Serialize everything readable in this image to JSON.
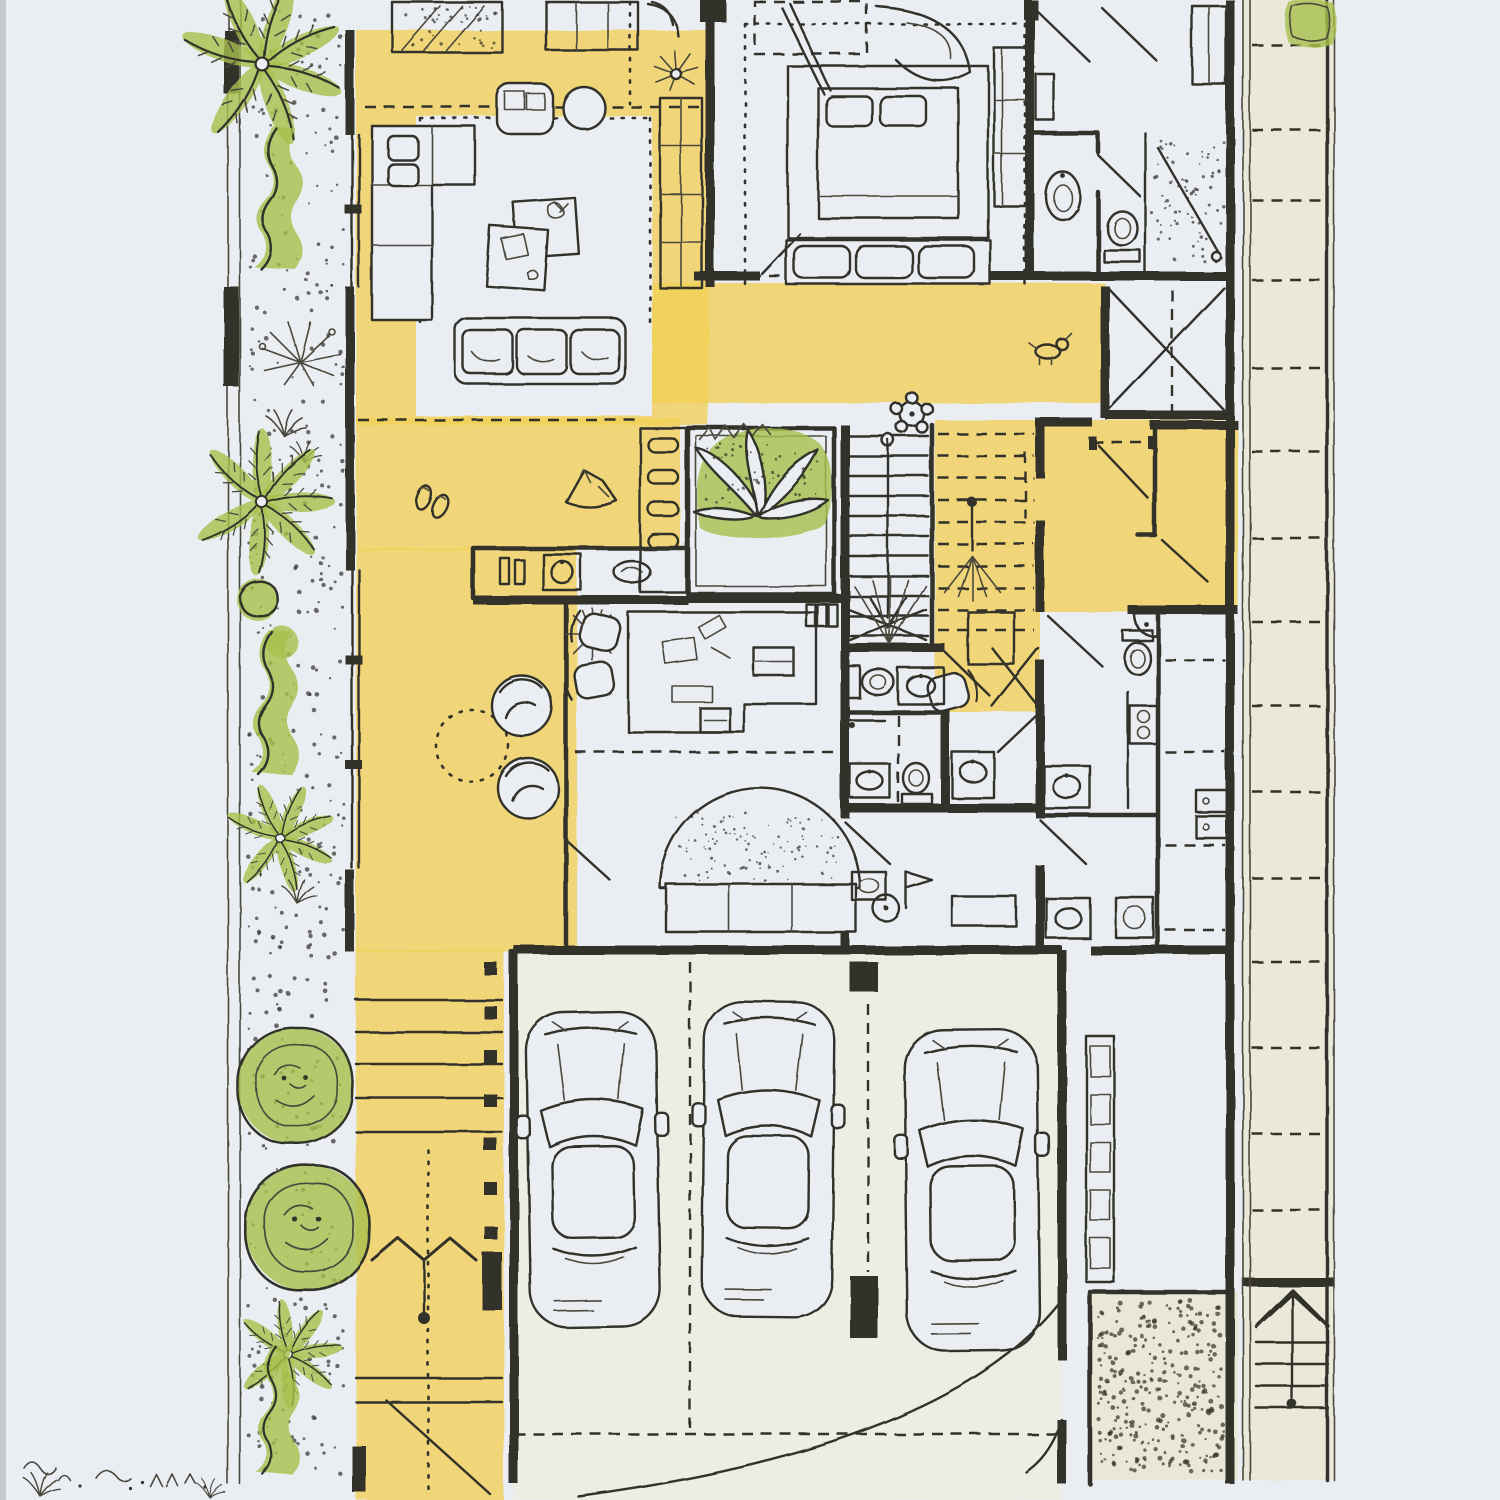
{
  "artwork": {
    "type": "Hand-drawn architectural floor plan, ink and watercolor",
    "visible_text": "",
    "subject": "ground floor of a narrow row-house lot with front garden strip, courtyard planter, stairs and three-car garage"
  },
  "palette": {
    "paper": "#eaeef3",
    "ink": "#32302a",
    "ink_soft": "#4c483e",
    "yellow_wash": "#f1cf55",
    "yellow_light": "#f6e184",
    "green_wash": "#a6bf4b",
    "green_deep": "#7e9c33",
    "beige_wash": "#e9e7d6",
    "garage_wash": "#eeece0",
    "edge_shadow": "#a6abb1"
  },
  "inventory": {
    "cars": 3,
    "garage_stalls": 3,
    "staircases": 3,
    "palm_trees": 4,
    "round_canopy_trees": 2,
    "hedge_patches": 3,
    "courtyard_planters": 1,
    "beds": 2,
    "sofas": 2,
    "armchairs": 1,
    "round_lounge_chairs": 2,
    "desks": 1,
    "desk_chairs": 3,
    "toilets": 5,
    "sinks": 8,
    "showers": 2,
    "sunburst_clocks": 2,
    "direction_arrows": 2
  },
  "legend": {
    "yellow_wash_means": "circulation, hall and terrace floors",
    "green_wash_means": "planting / trees",
    "stipple_means": "gravel and soft landscape"
  }
}
